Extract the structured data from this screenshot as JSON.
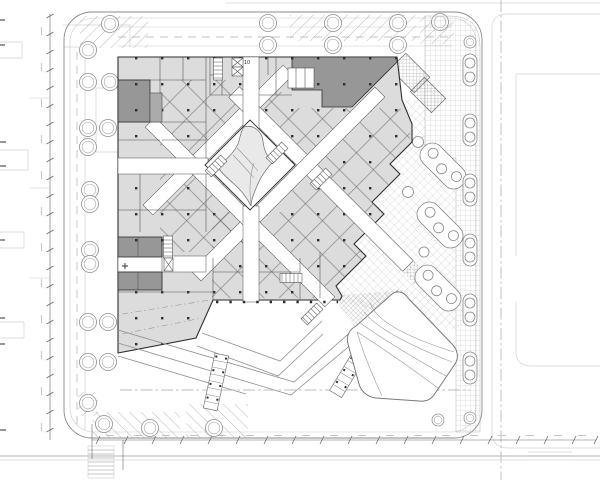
{
  "palette": {
    "paper": "#ffffff",
    "ink": "#2e2e2e",
    "wall": "#4a4a4a",
    "room": "#dcdcdc",
    "room_alt": "#e9e9e9",
    "dark": "#979797",
    "mid": "#9a9a9a",
    "faint": "#d4d4d4",
    "tree": "#8f8f8f",
    "dim": "#6a6a6a",
    "dim_text": "#c6c6c6"
  },
  "plan": {
    "room_label": "10"
  }
}
